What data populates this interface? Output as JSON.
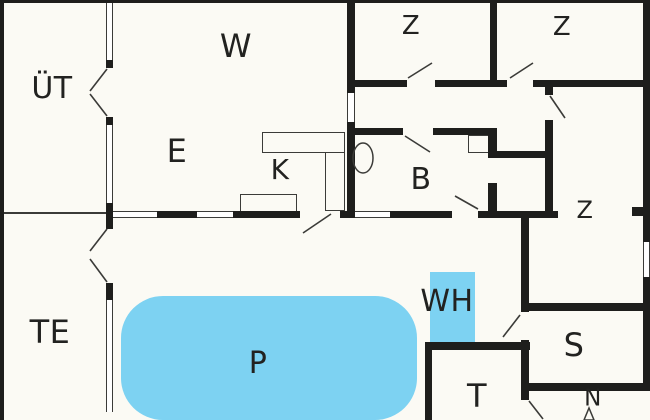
{
  "colors": {
    "bg": "#fbfaf4",
    "wall": "#1e1e1c",
    "line": "#3b3b38",
    "water": "#7dd2f2",
    "text": "#222220",
    "winfill": "#ffffff"
  },
  "rooms": {
    "uet": {
      "label": "ÜT"
    },
    "w": {
      "label": "W"
    },
    "z1": {
      "label": "Z"
    },
    "z2": {
      "label": "Z"
    },
    "e": {
      "label": "E"
    },
    "k": {
      "label": "K"
    },
    "b": {
      "label": "B"
    },
    "z3": {
      "label": "Z"
    },
    "te": {
      "label": "TE"
    },
    "p": {
      "label": "P"
    },
    "wh": {
      "label": "WH"
    },
    "s": {
      "label": "S"
    },
    "t": {
      "label": "T"
    }
  },
  "compass": {
    "label": "N"
  }
}
